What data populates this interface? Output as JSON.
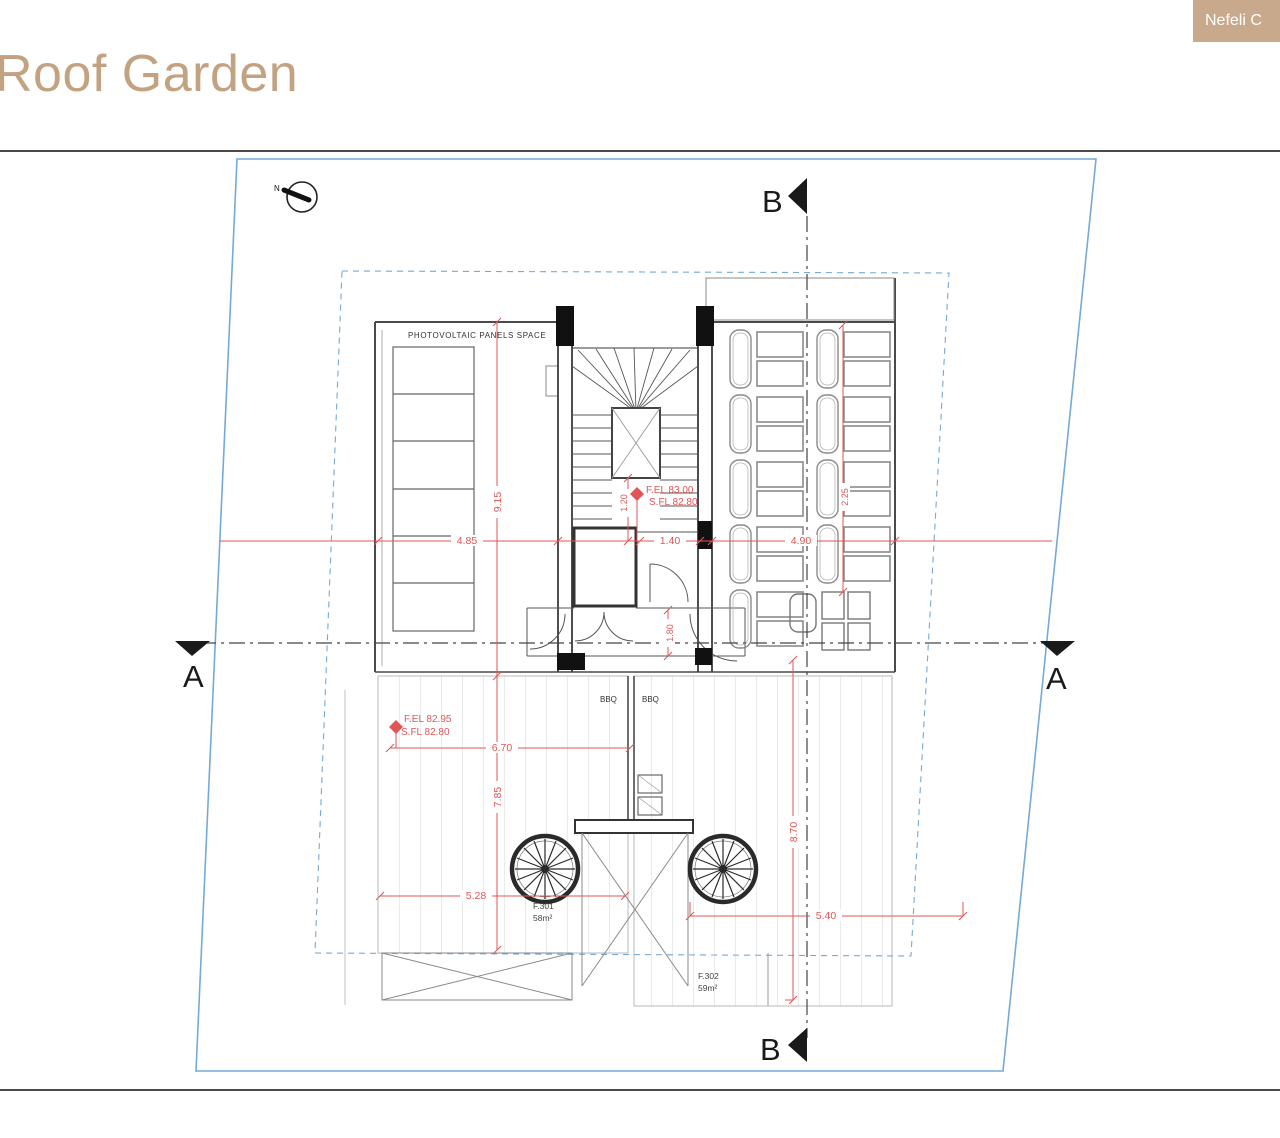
{
  "header": {
    "title": "Roof Garden",
    "badge": "Nefeli C"
  },
  "plan": {
    "north": "N",
    "marker_a": "A",
    "marker_b": "B",
    "pv_label": "PHOTOVOLTAIC PANELS SPACE",
    "bbq_left": "BBQ",
    "bbq_right": "BBQ",
    "unit1_code": "F.301",
    "unit1_area": "58m²",
    "unit2_code": "F.302",
    "unit2_area": "59m²",
    "elev_stair_line1": "F.EL 83.00",
    "elev_stair_line2": "S.FL 82.80",
    "elev_terrace_line1": "F.EL 82.95",
    "elev_terrace_line2": "S.FL 82.80",
    "dims": {
      "w_left": "4.85",
      "w_stair": "1.40",
      "w_pergola": "4.90",
      "h_upper": "9.15",
      "h_lower": "7.85",
      "w_terrace": "6.70",
      "w_unit301": "5.28",
      "w_unit302": "5.40",
      "h_unit302": "8.70",
      "h_lobby": "1.80",
      "h_stairwell": "1.20",
      "h_pergola": "2.25"
    },
    "colors": {
      "accent_tan": "#c2a280",
      "badge_bg": "#c9a98b",
      "boundary_blue": "#74a9d8",
      "dimension_red": "#e05555",
      "line_gray": "#555555",
      "wall_dark": "#1a1a1a"
    }
  }
}
